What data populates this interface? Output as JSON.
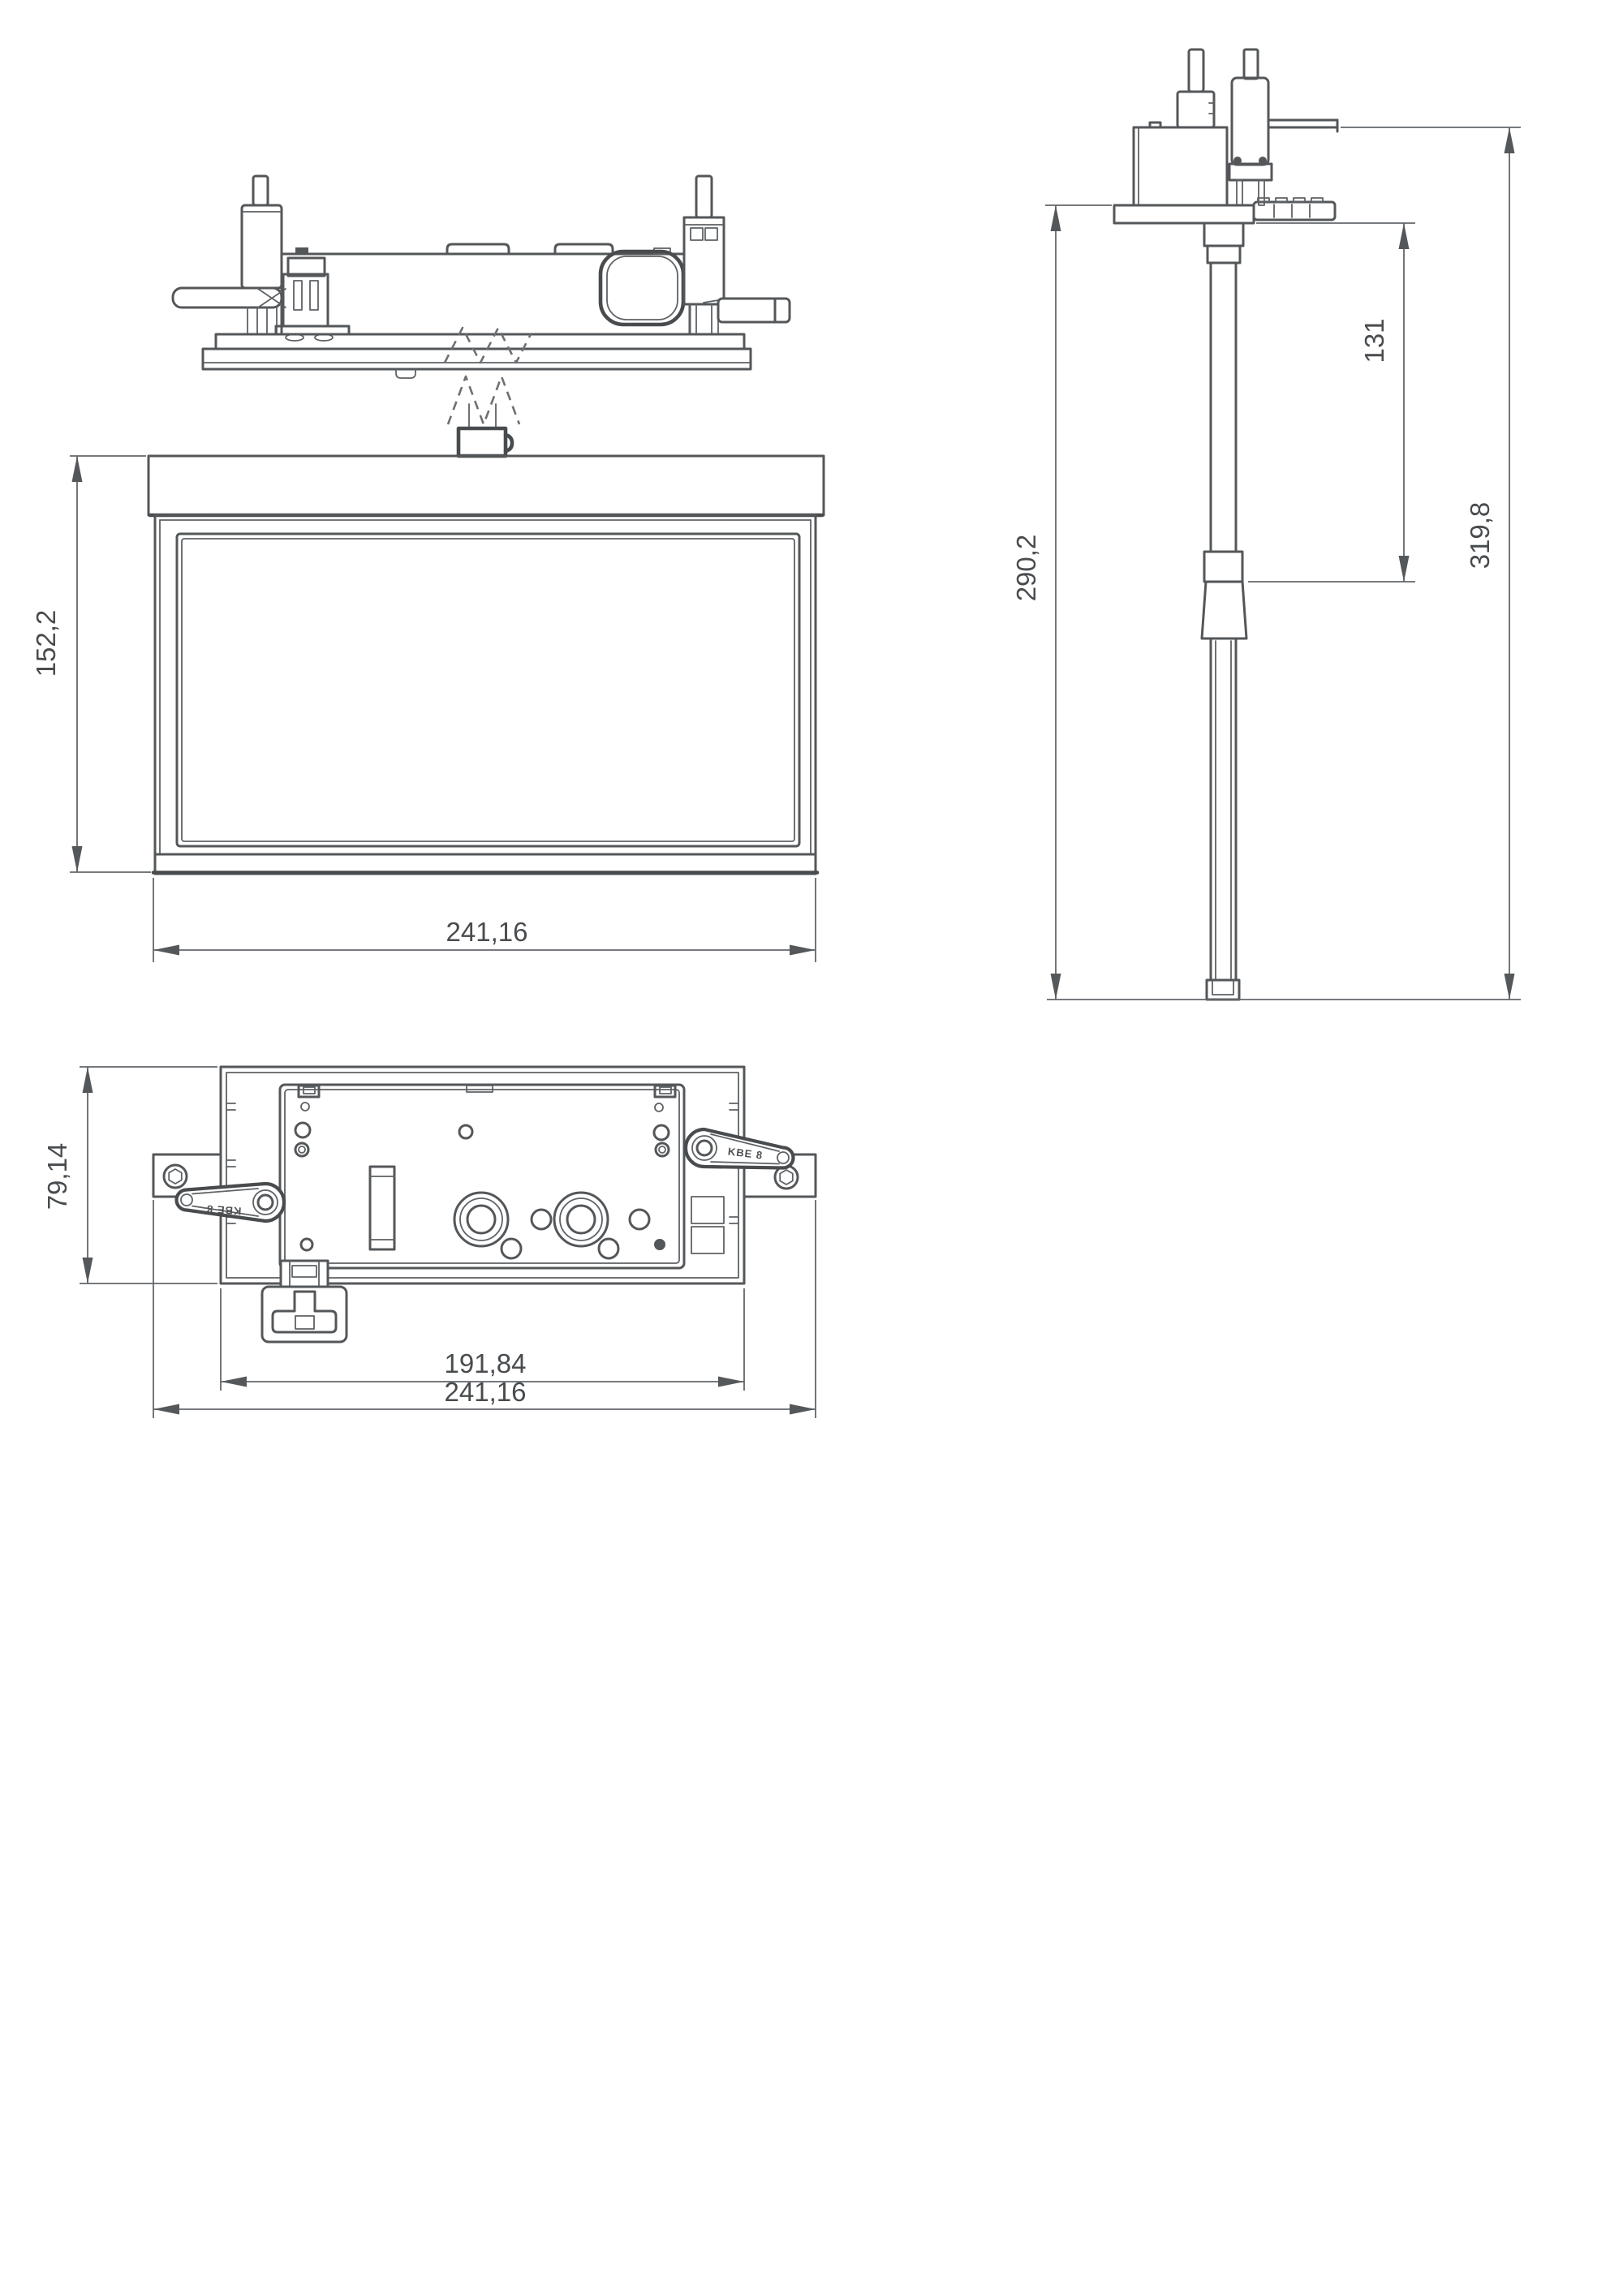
{
  "drawing": {
    "background": "#ffffff",
    "object_line_color": "#54575a",
    "dimension_line_color": "#63676b",
    "text_color": "#494c4f"
  },
  "views": {
    "front": {
      "dim_height": "152,2",
      "dim_width": "241,16"
    },
    "side": {
      "dim_suspension_length": "290,2",
      "dim_upper_tube": "131",
      "dim_total_height": "319,8"
    },
    "top": {
      "dim_depth": "79,14",
      "dim_body_width": "191,84",
      "dim_overall_width": "241,16",
      "arm_marking_left": "KBE 8",
      "arm_marking_right": "KBE 8"
    }
  }
}
